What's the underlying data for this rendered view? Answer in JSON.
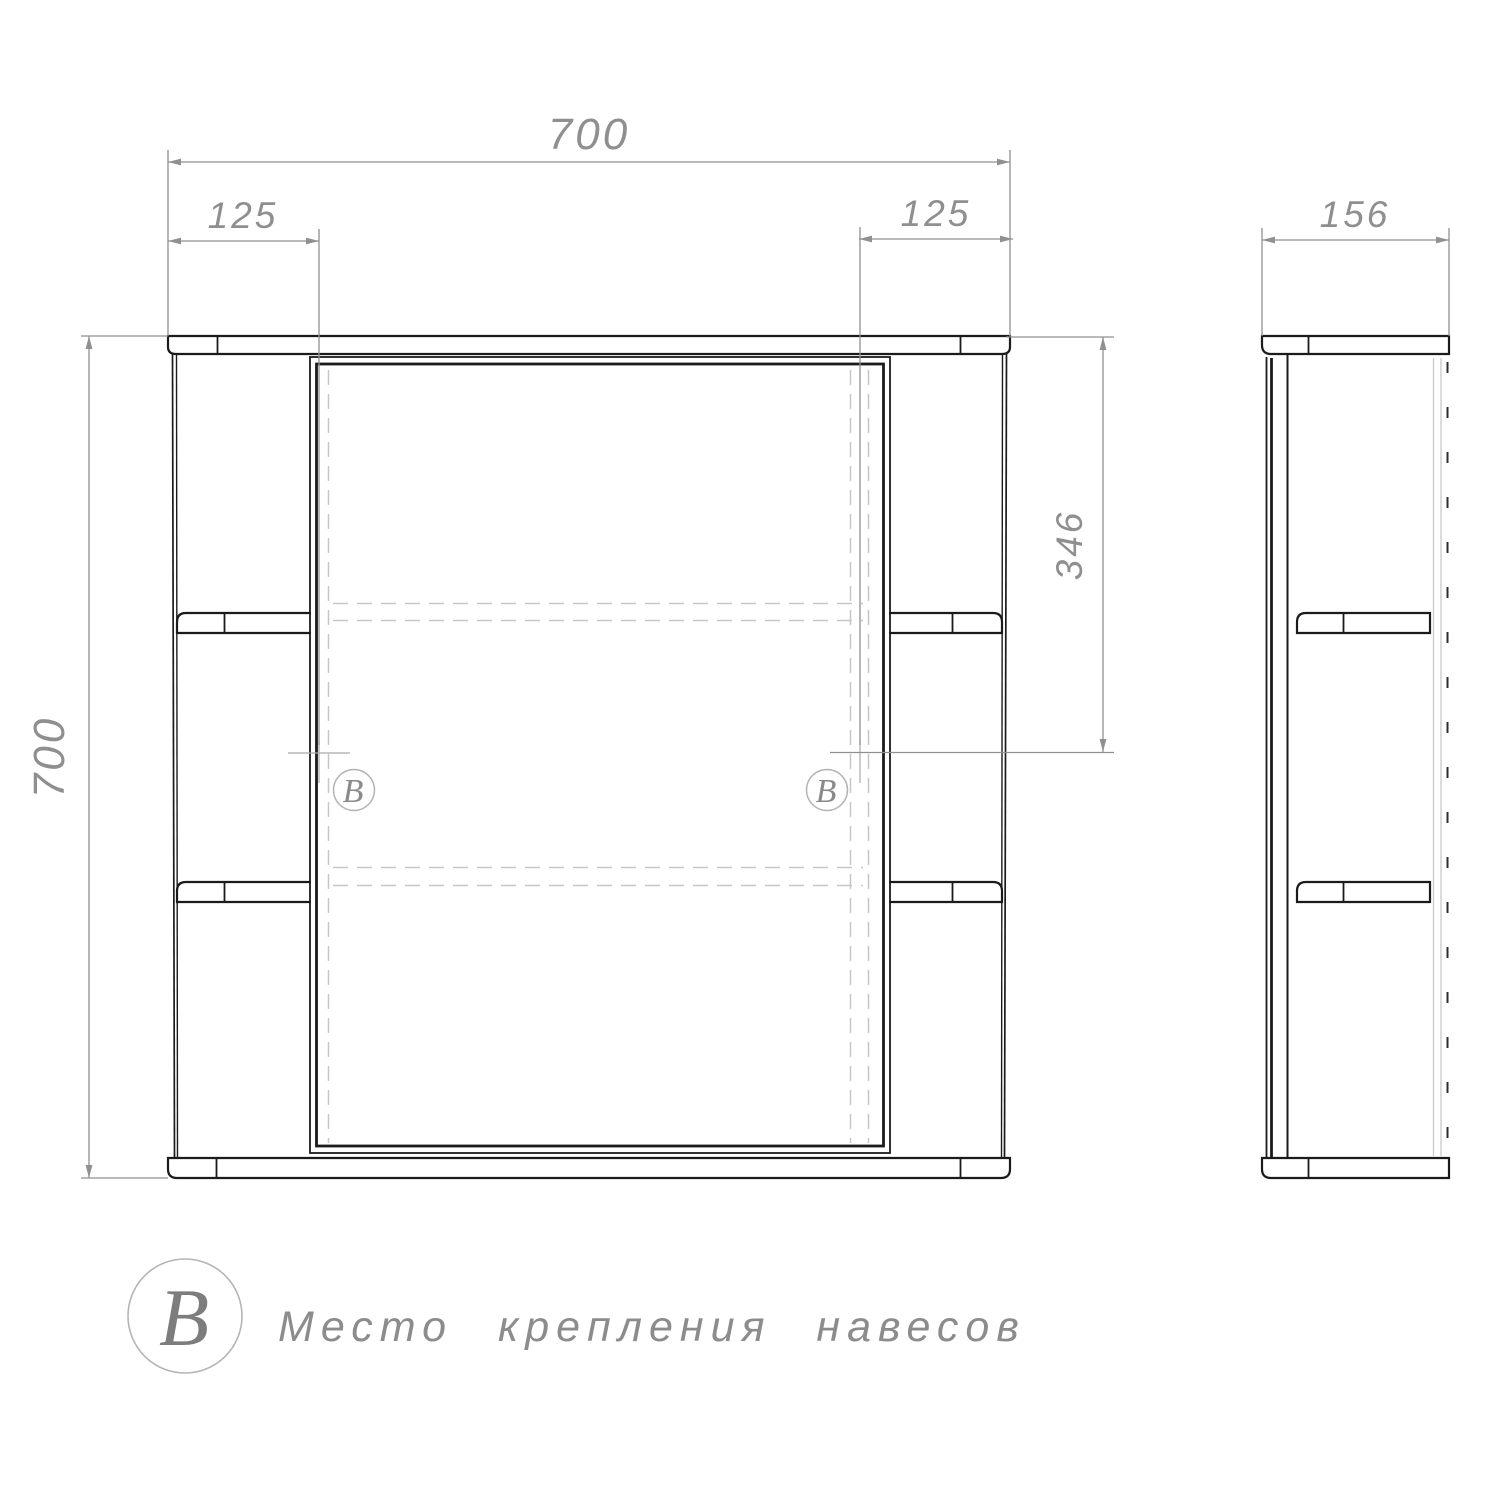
{
  "drawing": {
    "dimensions": {
      "overall_width": "700",
      "overall_height": "700",
      "depth": "156",
      "left_mount_offset": "125",
      "right_mount_offset": "125",
      "mount_from_top": "346"
    },
    "markers": {
      "left": "В",
      "right": "В"
    },
    "legend": {
      "symbol": "В",
      "label": "Место крепления навесов"
    },
    "colors": {
      "line": "#1b1b1b",
      "dimension": "#8f8f8f",
      "hidden_dash": "#c7c7c7",
      "marker_circle": "#b3b3b3",
      "background": "#ffffff"
    }
  }
}
